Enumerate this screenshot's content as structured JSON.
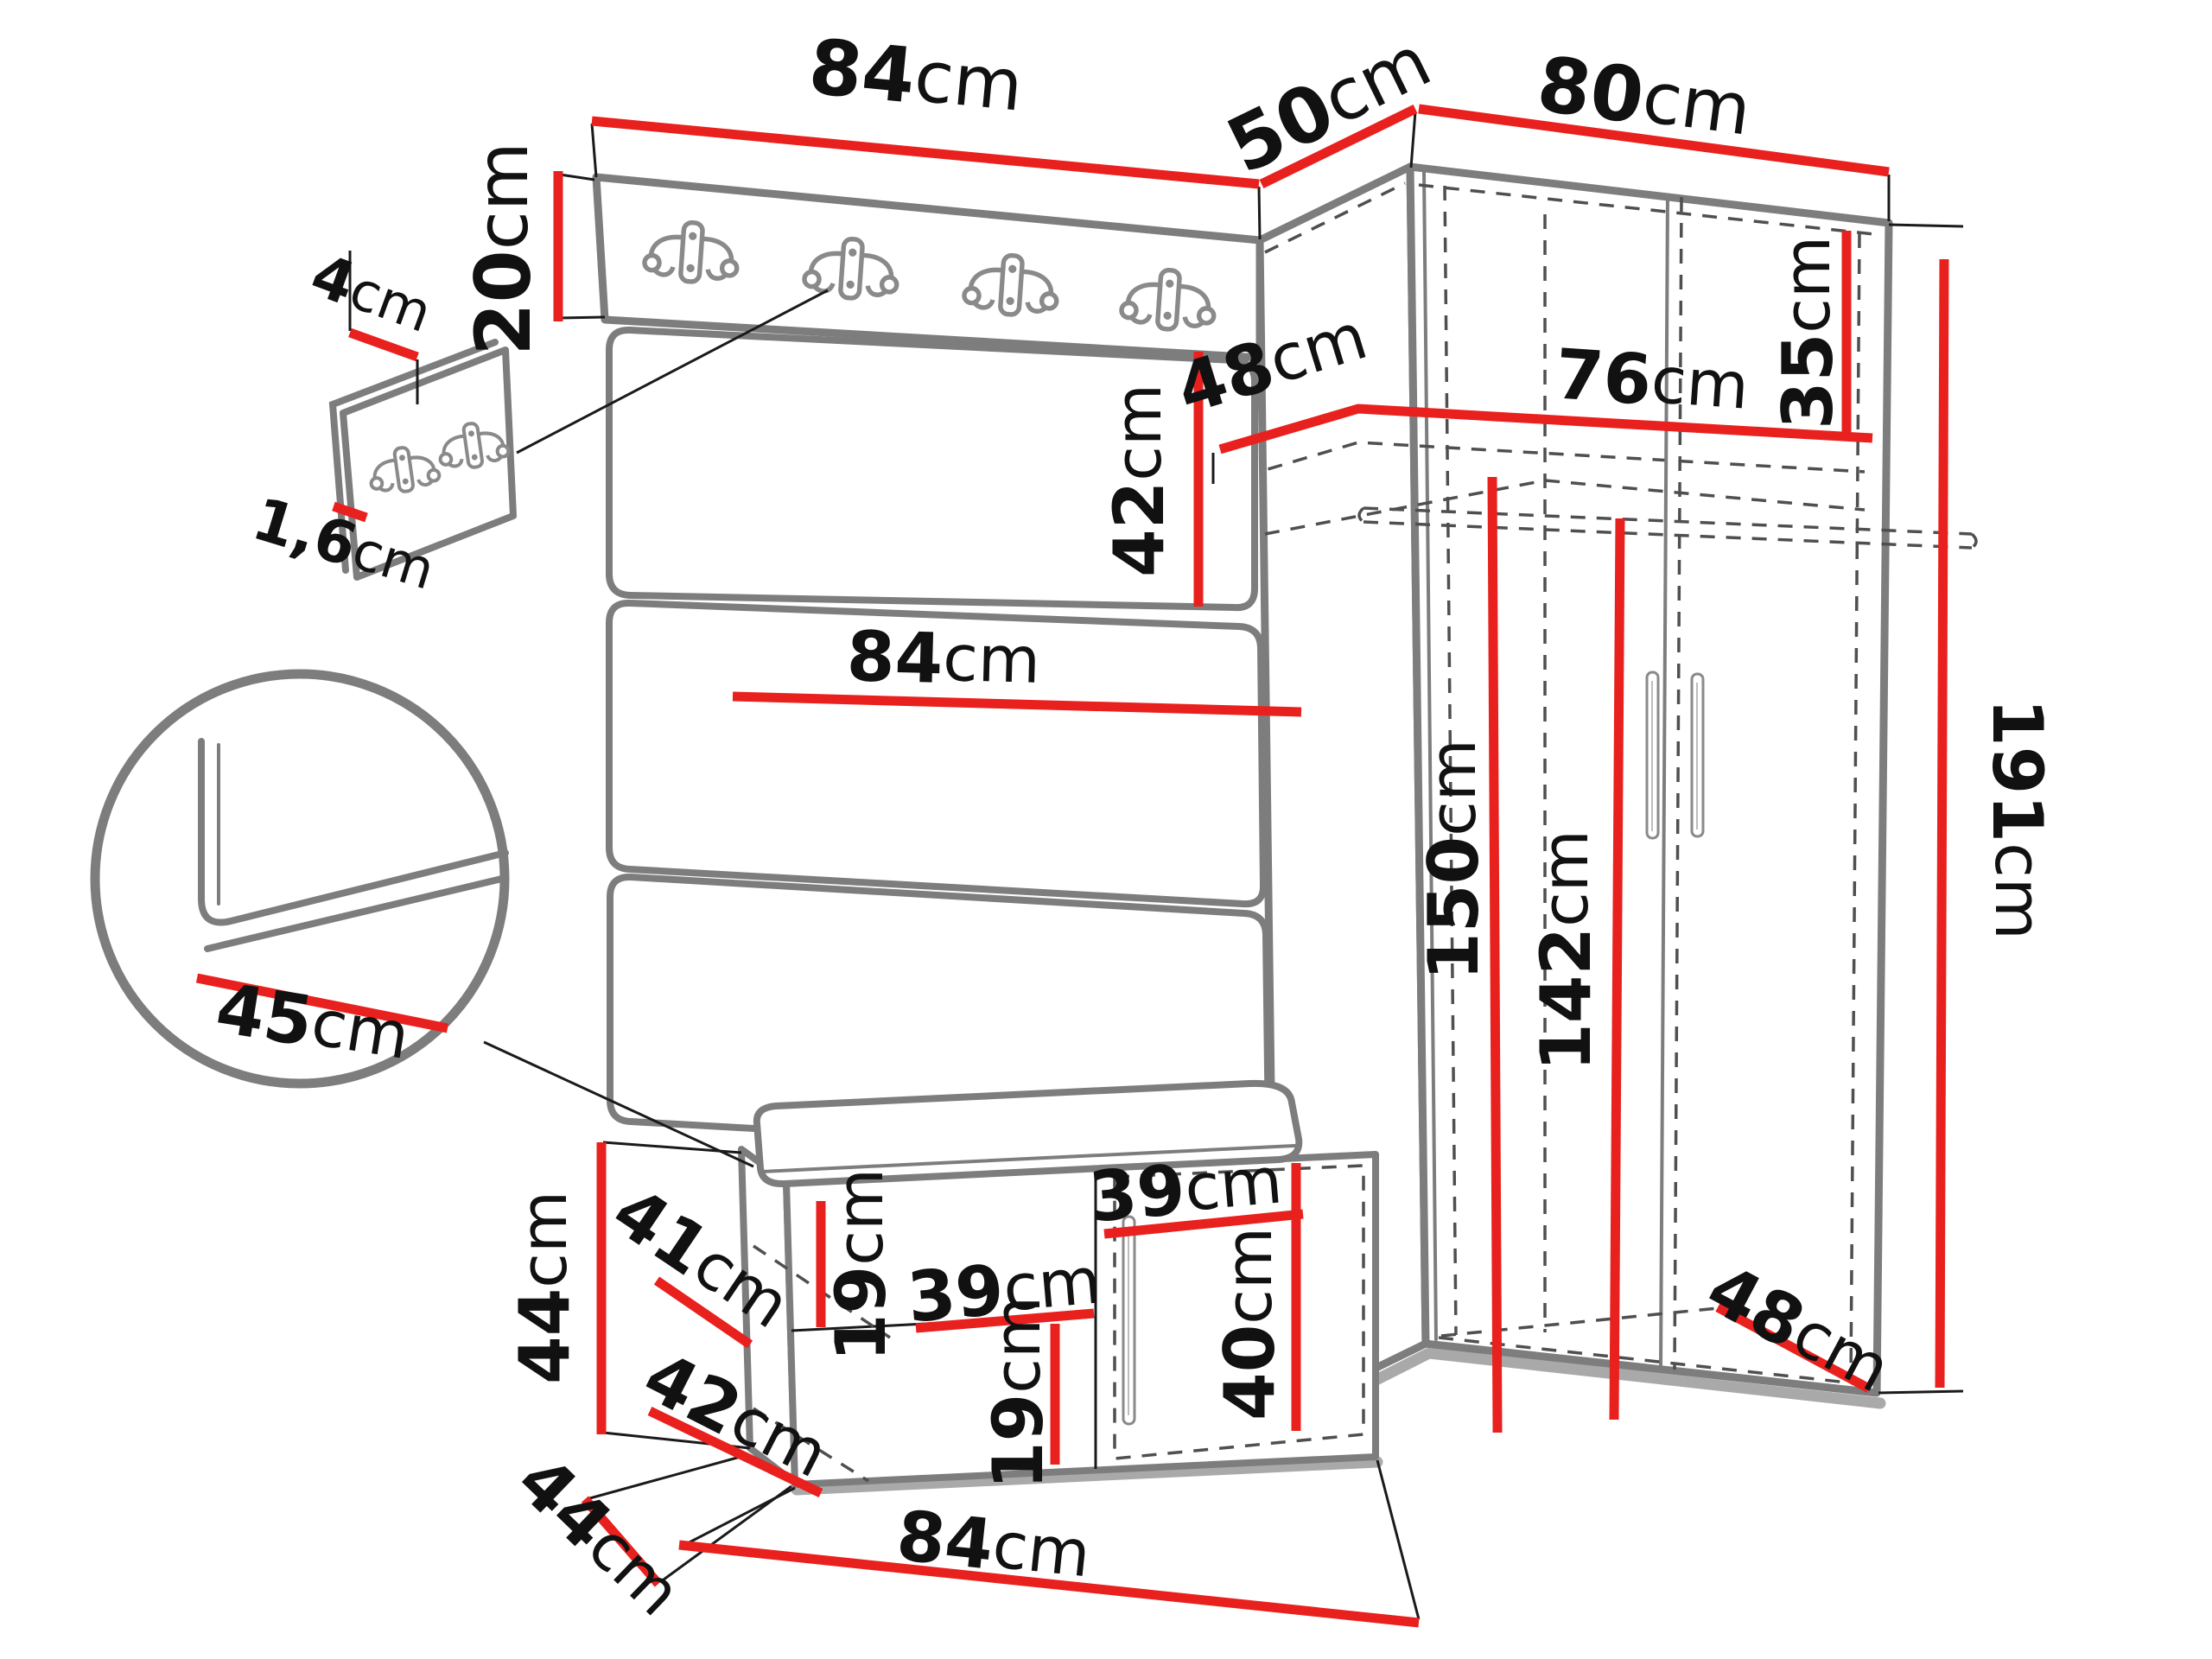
{
  "colors": {
    "dimension_red": "#e9211e",
    "outline_gray": "#7d7d7d",
    "dash_gray": "#4f4f4f",
    "extension_black": "#1a1a1a",
    "shadow_gray": "#a9a9a9",
    "text_black": "#111111",
    "background": "#ffffff"
  },
  "unit": "cm",
  "dims": {
    "hook_board_width": {
      "value": "84",
      "unit": "cm"
    },
    "corner_width": {
      "value": "50",
      "unit": "cm"
    },
    "wardrobe_width": {
      "value": "80",
      "unit": "cm"
    },
    "hook_board_height": {
      "value": "20",
      "unit": "cm"
    },
    "mini_panel_width": {
      "value": "4",
      "unit": "cm"
    },
    "mini_panel_thickness": {
      "value": "1,6",
      "unit": "cm"
    },
    "cushion_height": {
      "value": "42",
      "unit": "cm"
    },
    "panel_width": {
      "value": "84",
      "unit": "cm"
    },
    "top_shelf_depth": {
      "value": "48",
      "unit": "cm"
    },
    "top_shelf_width": {
      "value": "76",
      "unit": "cm"
    },
    "top_shelf_height": {
      "value": "35",
      "unit": "cm"
    },
    "interior_height_left": {
      "value": "150",
      "unit": "cm"
    },
    "interior_height_right": {
      "value": "142",
      "unit": "cm"
    },
    "wardrobe_height": {
      "value": "191",
      "unit": "cm"
    },
    "seat_depth_detail": {
      "value": "45",
      "unit": "cm"
    },
    "bench_height": {
      "value": "44",
      "unit": "cm"
    },
    "bench_shelf_depth": {
      "value": "41",
      "unit": "cm"
    },
    "bench_gap_upper": {
      "value": "19",
      "unit": "cm"
    },
    "bench_shelf_width": {
      "value": "39",
      "unit": "cm"
    },
    "bench_gap_lower": {
      "value": "19",
      "unit": "cm"
    },
    "bench_bottom_width": {
      "value": "42",
      "unit": "cm"
    },
    "bench_depth": {
      "value": "44",
      "unit": "cm"
    },
    "bench_width": {
      "value": "84",
      "unit": "cm"
    },
    "bench_door_width": {
      "value": "39",
      "unit": "cm"
    },
    "bench_door_height": {
      "value": "40",
      "unit": "cm"
    },
    "wardrobe_depth": {
      "value": "48",
      "unit": "cm"
    }
  }
}
